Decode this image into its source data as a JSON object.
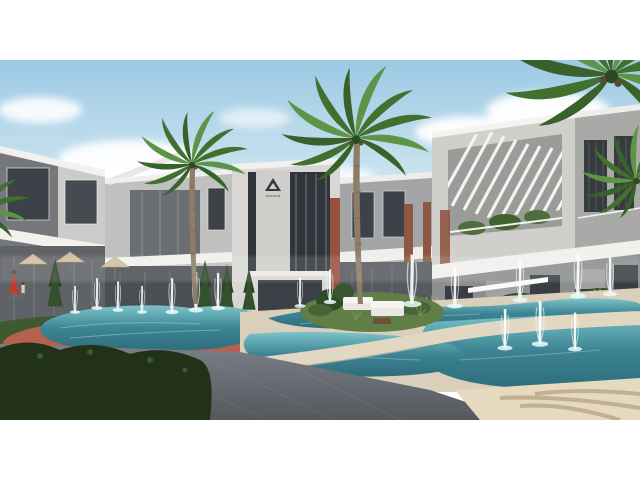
{
  "meta": {
    "type": "architectural-render-photo",
    "description": "Exterior CGI render of a modern residential compound: rows of three-storey grey/white townhouses, tall palm trees, curved lagoon pools with fountain jets, landscaped hedges, a central island with white outdoor sofas, stone plaza in foreground, white letterbox bars above and below the 16:9 image.",
    "letterbox_color": "#ffffff"
  },
  "logo": {
    "icon": "triangle-logo",
    "text": "TROWON"
  },
  "palette": {
    "sky_top": "#9cc9e4",
    "sky_horizon": "#edf4f6",
    "cloud": "#ffffff",
    "building_light": "#d6d5d2",
    "building_mid": "#a7a8a8",
    "building_dark": "#6f7276",
    "glass_dark": "#333a3f",
    "fascia_white": "#f2f1ee",
    "brick": "#96523f",
    "hedge": "#3f5a33",
    "grass": "#6d8c4f",
    "dry_grass": "#b9ab72",
    "water_deep": "#2e6d7c",
    "water_light": "#8ccfd2",
    "deck_sun": "#e8dfc8",
    "deck_shade": "#cdc4b1",
    "terracotta": "#b4624c",
    "plaza": "#6e747c",
    "bush_dark": "#20301b",
    "palm_green": "#4a7a3c",
    "trunk": "#8d7c68",
    "dress_red": "#c23a2c"
  },
  "scene": {
    "palm_trees": 4,
    "fountain_jets": 17,
    "pools": 2,
    "umbrellas": 3,
    "people": 2,
    "sofas": 2
  }
}
